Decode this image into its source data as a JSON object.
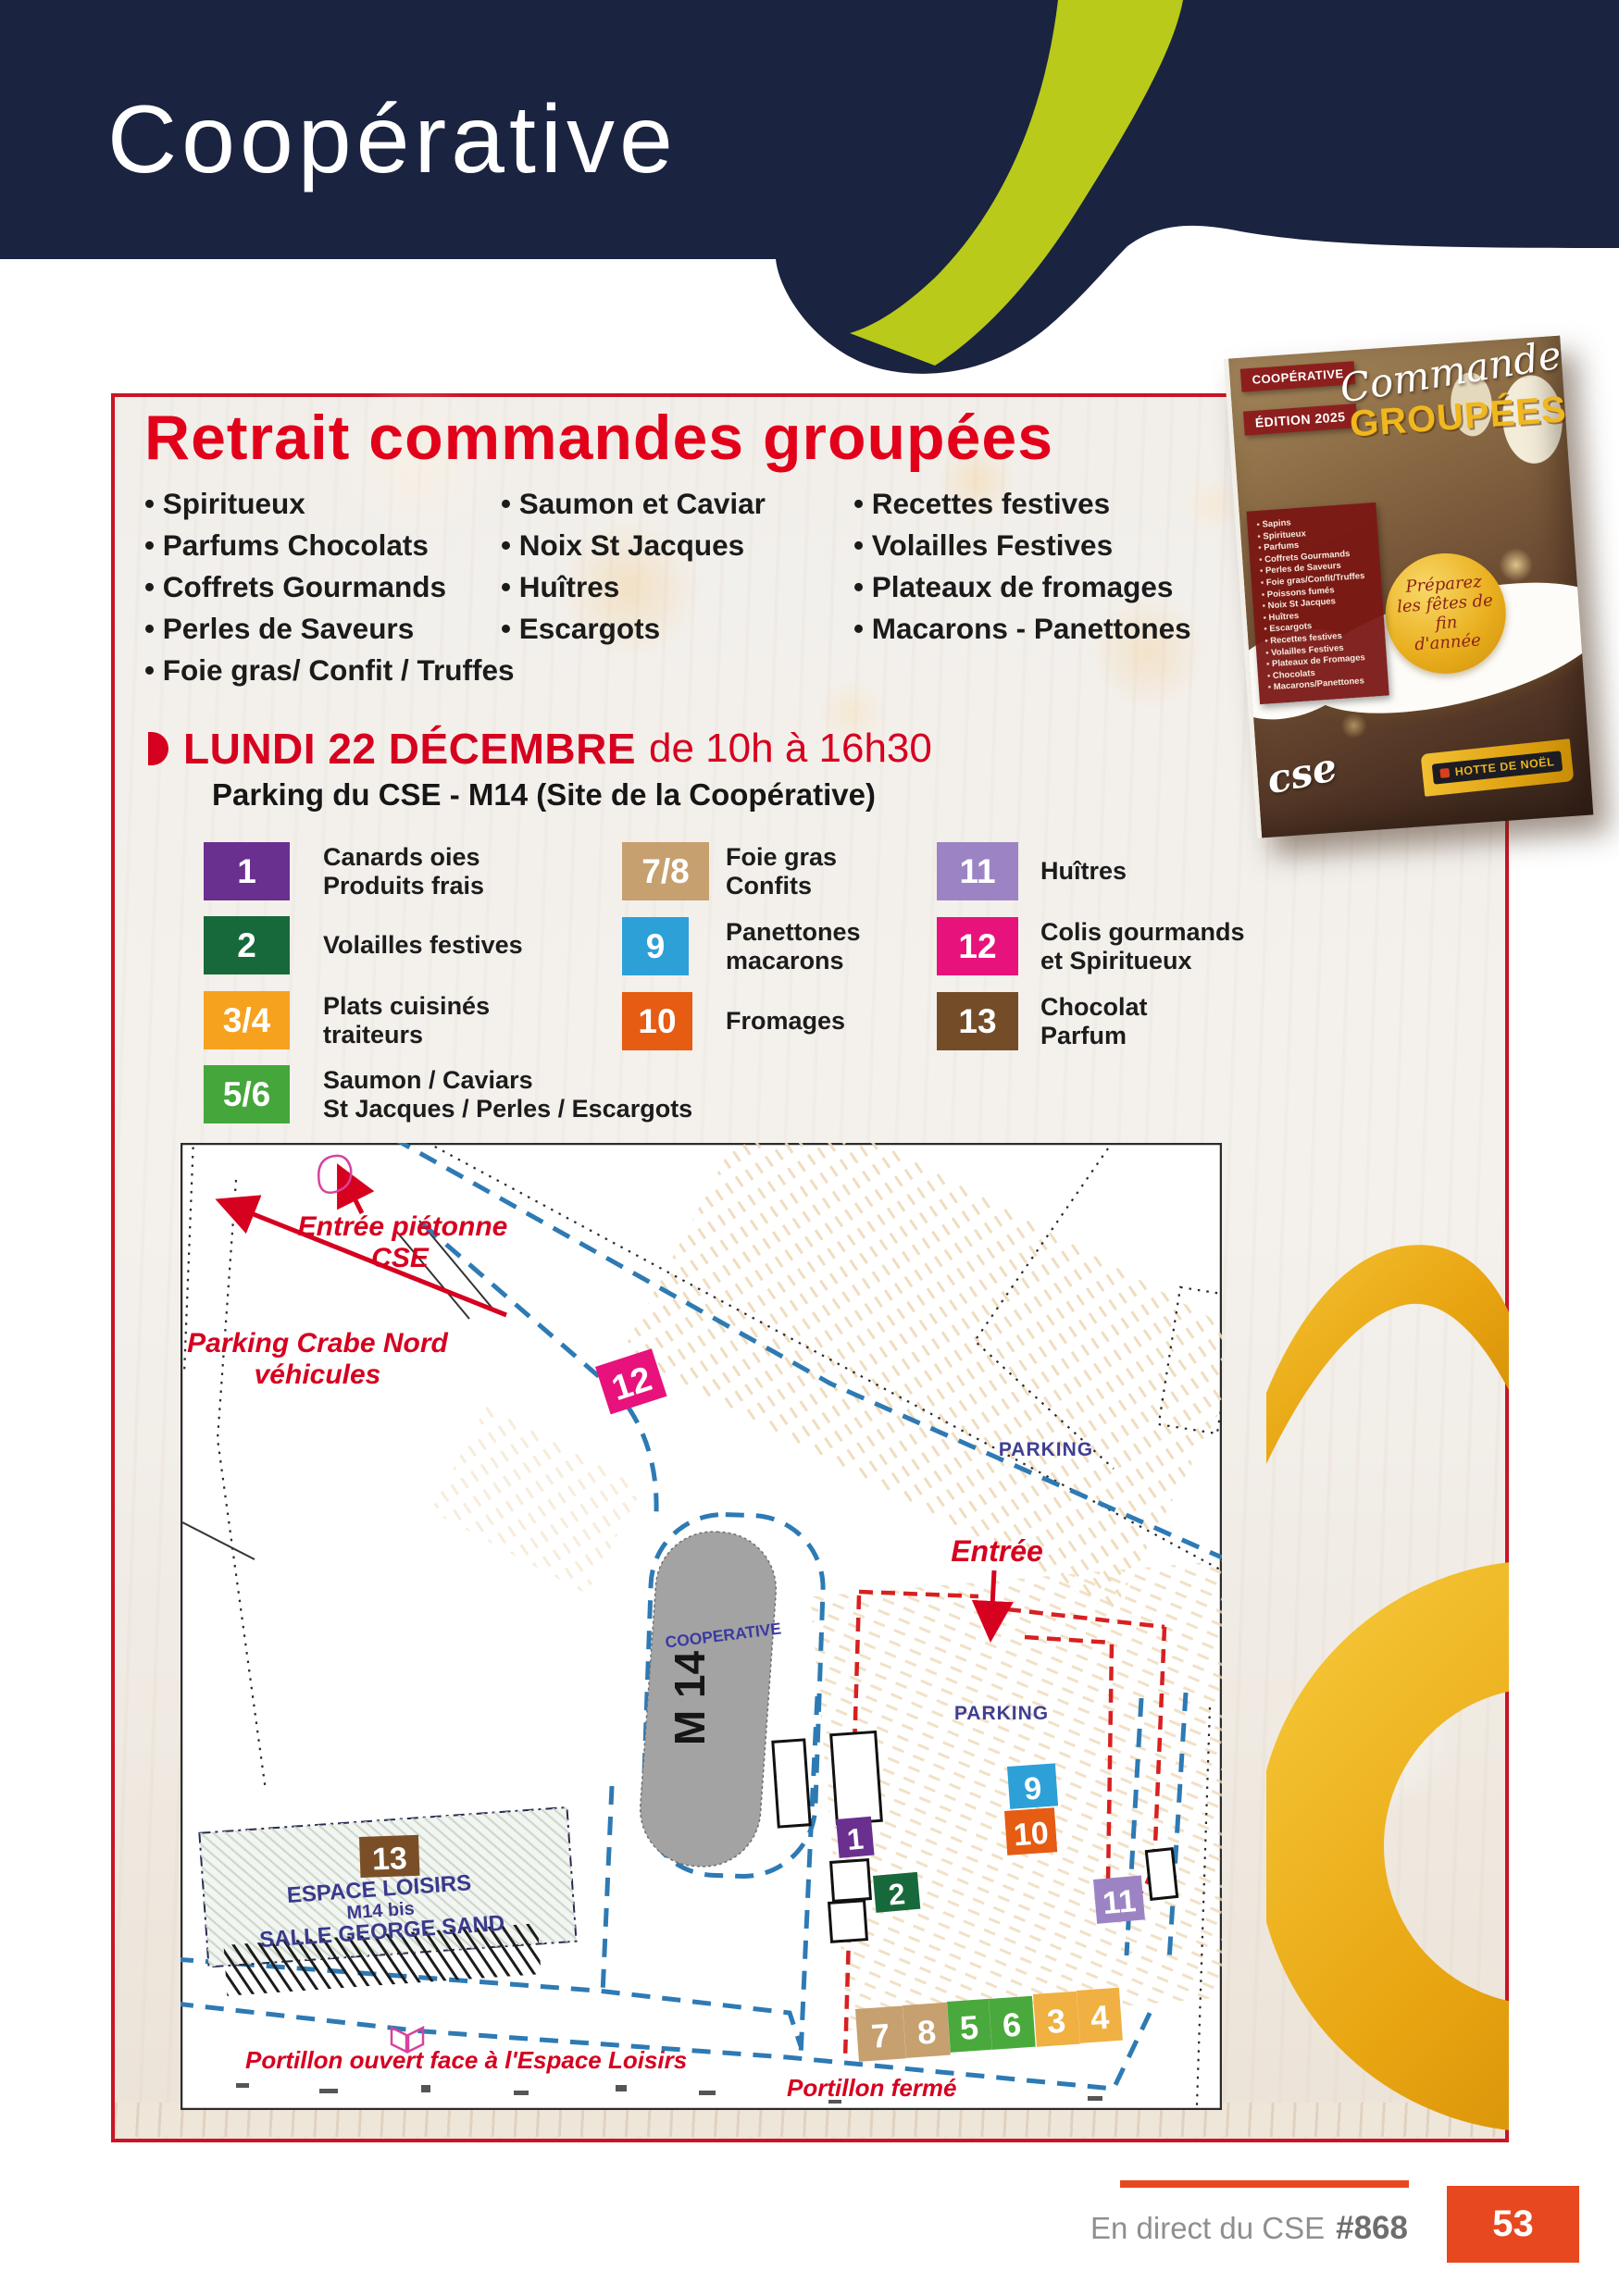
{
  "colors": {
    "header_navy": "#1a2340",
    "lime_green": "#b9ca1a",
    "accent_red": "#e2001a",
    "box_border_red": "#c81526",
    "footer_orange": "#e8481f",
    "gold": "#e8b421",
    "map_blue_dash": "#2d7ab4",
    "map_red_dash": "#d82020",
    "parking_label_blue": "#3f3f94"
  },
  "header": {
    "title": "Coopérative"
  },
  "intro": {
    "title": "Retrait commandes groupées",
    "columns": [
      [
        "Spiritueux",
        "Parfums Chocolats",
        "Coffrets Gourmands",
        "Perles de Saveurs",
        "Foie gras/ Confit / Truffes"
      ],
      [
        "Saumon et Caviar",
        "Noix St Jacques",
        "Huîtres",
        "Escargots"
      ],
      [
        "Recettes festives",
        "Volailles Festives",
        "Plateaux de fromages",
        "Macarons - Panettones"
      ]
    ]
  },
  "event": {
    "date": "LUNDI 22 DÉCEMBRE",
    "time": "de 10h à 16h30",
    "location": "Parking du CSE - M14 (Site de la Coopérative)"
  },
  "legend": {
    "col1": [
      {
        "num": "1",
        "color": "#6a3090",
        "lines": [
          "Canards oies",
          "Produits frais"
        ]
      },
      {
        "num": "2",
        "color": "#17693c",
        "lines": [
          "Volailles festives"
        ]
      },
      {
        "num": "3/4",
        "color": "#f6a21f",
        "lines": [
          "Plats cuisinés",
          "traiteurs"
        ]
      },
      {
        "num": "5/6",
        "color": "#45a63c",
        "lines": [
          "Saumon / Caviars",
          "St Jacques / Perles / Escargots"
        ]
      }
    ],
    "col2": [
      {
        "num": "7/8",
        "color": "#c6a06e",
        "lines": [
          "Foie gras",
          "Confits"
        ]
      },
      {
        "num": "9",
        "color": "#2da0d8",
        "lines": [
          "Panettones",
          "macarons"
        ]
      },
      {
        "num": "10",
        "color": "#e55c12",
        "lines": [
          "Fromages"
        ]
      }
    ],
    "col3": [
      {
        "num": "11",
        "color": "#9c84c4",
        "lines": [
          "Huîtres"
        ]
      },
      {
        "num": "12",
        "color": "#e8127c",
        "lines": [
          "Colis gourmands",
          "et Spiritueux"
        ]
      },
      {
        "num": "13",
        "color": "#744d28",
        "lines": [
          "Chocolat",
          "Parfum"
        ]
      }
    ]
  },
  "map": {
    "labels": {
      "pedestrian1": "Entrée piétonne",
      "pedestrian2": "CSE",
      "crabe1": "Parking Crabe Nord",
      "crabe2": "véhicules",
      "parking1": "PARKING",
      "parking2": "PARKING",
      "entry": "Entrée",
      "cooperative": "COOPERATIVE",
      "building": "M 14",
      "espace1": "ESPACE LOISIRS",
      "espace2": "M14 bis",
      "espace3": "SALLE GEORGE SAND",
      "gate_open": "Portillon ouvert face à l'Espace Loisirs",
      "gate_closed": "Portillon fermé"
    },
    "markers": [
      {
        "num": "12",
        "color": "#e8127c"
      },
      {
        "num": "1",
        "color": "#6a3090"
      },
      {
        "num": "2",
        "color": "#17693c"
      },
      {
        "num": "9",
        "color": "#2da0d8"
      },
      {
        "num": "10",
        "color": "#e55c12"
      },
      {
        "num": "11",
        "color": "#9c84c4"
      },
      {
        "num": "7",
        "color": "#c6a06e"
      },
      {
        "num": "8",
        "color": "#c6a06e"
      },
      {
        "num": "5",
        "color": "#4aa93c"
      },
      {
        "num": "6",
        "color": "#4aa93c"
      },
      {
        "num": "3",
        "color": "#f0b042"
      },
      {
        "num": "4",
        "color": "#f0b042"
      },
      {
        "num": "13",
        "color": "#7a4f28"
      }
    ]
  },
  "catalog": {
    "tag1": "COOPÉRATIVE",
    "tag2": "ÉDITION 2025",
    "script_title": "Commandes",
    "title": "GROUPÉES",
    "circle_lines": [
      "Préparez",
      "les fêtes de fin",
      "d'année"
    ],
    "products": [
      "Sapins",
      "Spiritueux",
      "Parfums",
      "Coffrets Gourmands",
      "Perles de Saveurs",
      "Foie gras/Confit/Truffes",
      "Poissons fumés",
      "Noix St Jacques",
      "Huîtres",
      "Escargots",
      "Recettes festives",
      "Volailles Festives",
      "Plateaux de Fromages",
      "Chocolats",
      "Macarons/Panettones"
    ],
    "logo": "cse",
    "banner": "HOTTE DE NOËL"
  },
  "footer": {
    "label": "En direct du CSE",
    "issue": "#868",
    "page": "53"
  }
}
